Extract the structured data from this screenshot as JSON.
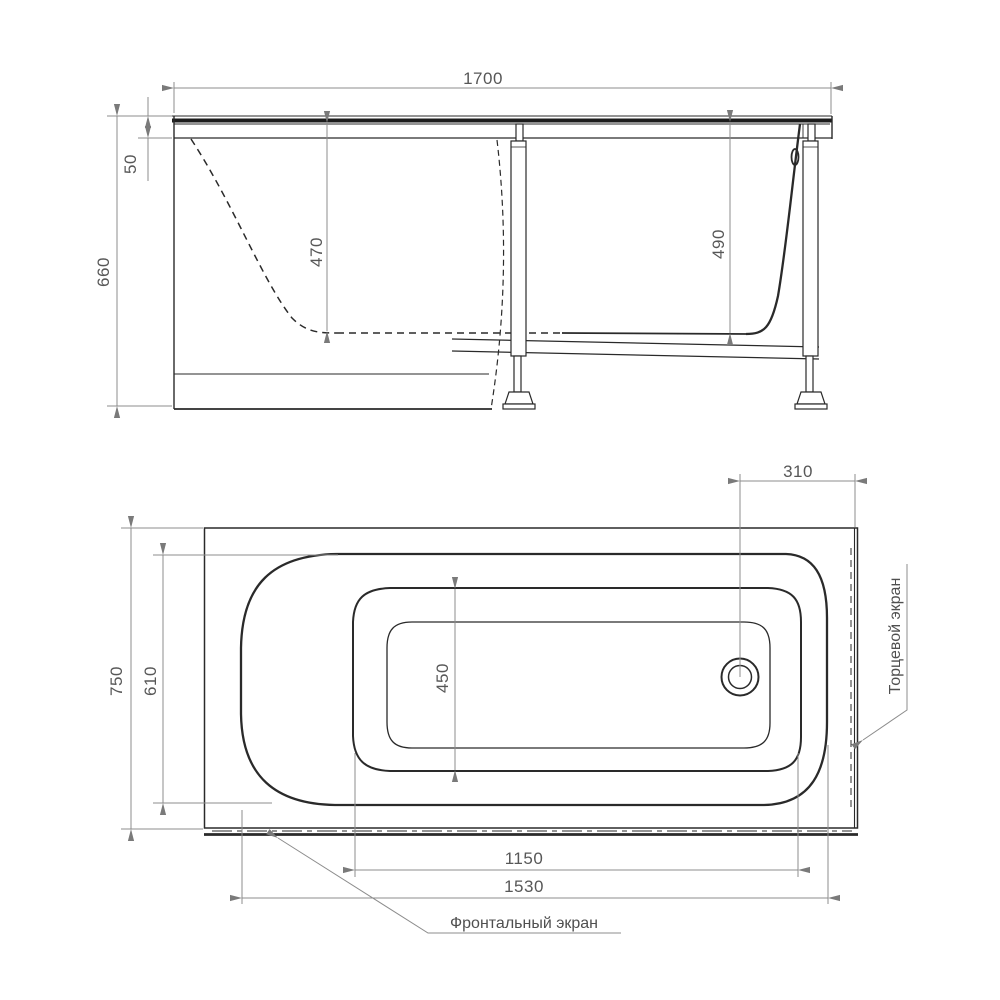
{
  "side_view": {
    "dims": {
      "length": "1700",
      "rim_height": "50",
      "total_height": "660",
      "depth_interior": "470",
      "depth_drain_end": "490"
    }
  },
  "plan_view": {
    "dims": {
      "drain_to_edge": "310",
      "overall_width": "750",
      "rim_inner_width": "610",
      "bottom_width": "450",
      "bottom_length": "1150",
      "front_screen_length": "1530"
    },
    "labels": {
      "end_screen": "Торцевой экран",
      "front_screen": "Фронтальный экран"
    }
  },
  "colors": {
    "outline": "#2a2a2a",
    "dimension_line": "#8c8c8c",
    "dimension_text": "#575757",
    "background": "#ffffff"
  }
}
